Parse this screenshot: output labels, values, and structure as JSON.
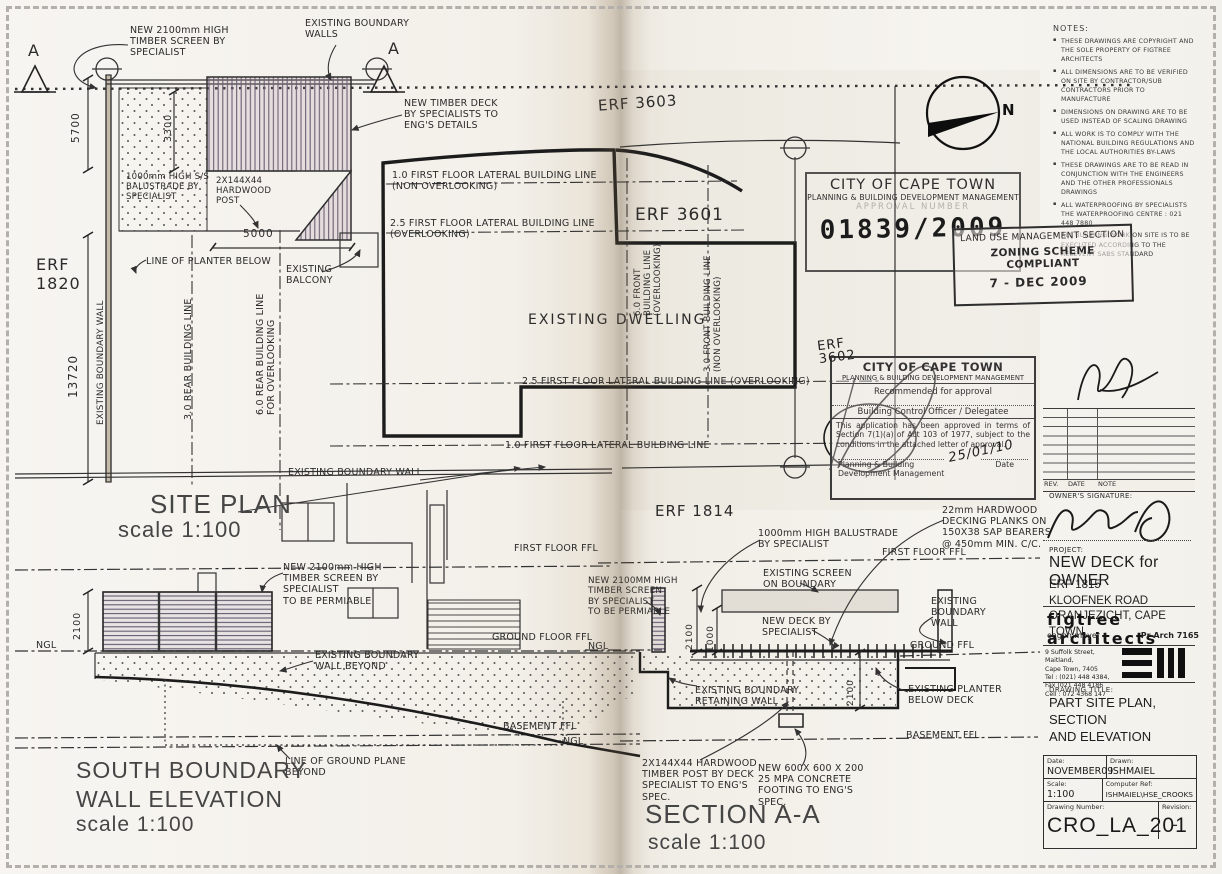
{
  "compass": {
    "n": "N"
  },
  "site_plan": {
    "title": "SITE PLAN",
    "scale": "scale 1:100",
    "marker_a_left": "A",
    "marker_a_right": "A",
    "erf_1820": "ERF\n1820",
    "erf_3603": "ERF 3603",
    "erf_3601": "ERF 3601",
    "erf_1814": "ERF 1814",
    "dims": {
      "d5700": "5700",
      "d3300": "3300",
      "d5000": "5000",
      "d13720": "13720"
    },
    "ann": {
      "new_screen": "NEW 2100mm HIGH\nTIMBER SCREEN BY\nSPECIALIST",
      "existing_boundary_walls": "EXISTING BOUNDARY\nWALLS",
      "new_timber_deck": "NEW TIMBER DECK\nBY SPECIALISTS TO\nENG'S DETAILS",
      "balustrade": "1000mm HIGH S/S\nBALUSTRADE BY\nSPECIALIST",
      "hardwood_post": "2X144X44\nHARDWOOD\nPOST",
      "line_planter": "LINE OF PLANTER BELOW",
      "existing_balcony": "EXISTING\nBALCONY",
      "boundary_wall_left": "EXISTING BOUNDARY WALL",
      "rear_3_0": "3.0 REAR BUILDING LINE",
      "rear_6_0": "6.0 REAR BUILDING LINE\nFOR OVERLOOKING",
      "lateral_1_0_top": "1.0 FIRST FLOOR LATERAL BUILDING LINE\n(NON OVERLOOKING)",
      "lateral_2_5_top": "2.5 FIRST FLOOR LATERAL BUILDING LINE\n(OVERLOOKING)",
      "existing_dwelling": "EXISTING DWELLING",
      "front_6_0": "6.0 FRONT\nBUILDING LINE\n(OVERLOOKING)",
      "front_3_0": "3.0 FRONT BUILDING LINE\n(NON OVERLOOKING)",
      "lateral_2_5_bottom": "2.5 FIRST FLOOR LATERAL BUILDING LINE (OVERLOOKING)",
      "lateral_1_0_bottom": "1.0 FIRST FLOOR LATERAL BUILDING LINE",
      "boundary_wall_bottom": "EXISTING BOUNDARY WALL"
    }
  },
  "elevation": {
    "title": "SOUTH BOUNDARY\nWALL ELEVATION",
    "scale": "scale 1:100",
    "ann": {
      "first_floor_ffl": "FIRST FLOOR FFL",
      "new_screen": "NEW 2100mm HIGH\nTIMBER SCREEN BY\nSPECIALIST\nTO BE PERMIABLE",
      "dim_2100": "2100",
      "ngl_left": "NGL",
      "ground_floor_ffl": "GROUND FLOOR FFL",
      "boundary_beyond": "EXISTING BOUNDARY\nWALL BEYOND",
      "basement_ffl": "BASEMENT FFL",
      "ngl_right": "NGL",
      "ground_plane": "LINE OF GROUND PLANE\nBEYOND"
    }
  },
  "section": {
    "title": "SECTION A-A",
    "scale": "scale 1:100",
    "ann": {
      "balustrade": "1000mm HIGH BALUSTRADE\nBY SPECIALIST",
      "decking": "22mm HARDWOOD\nDECKING PLANKS ON\n150X38 SAP BEARERS\n@ 450mm MIN. C/C.",
      "first_floor_ffl": "FIRST FLOOR FFL",
      "new_screen": "NEW 2100MM HIGH\nTIMBER SCREEN\nBY SPECIALIST\nTO BE PERMIABLE",
      "existing_screen": "EXISTING SCREEN\nON BOUNDARY",
      "new_deck": "NEW DECK BY\nSPECIALIST",
      "boundary_wall": "EXISTING\nBOUNDARY\nWALL",
      "ngl": "NGL",
      "ground_ffl": "GROUND FFL",
      "dim_2100": "2100",
      "dim_1000": "1000",
      "dim_2100_b": "2100",
      "retaining_wall": "EXISTING BOUNDARY\nRETAINING WALL",
      "planter": "EXISTING PLANTER\nBELOW DECK",
      "basement_ffl": "BASEMENT FFL",
      "timber_post": "2X144X44 HARDWOOD\nTIMBER POST BY DECK\nSPECIALIST TO ENG'S\nSPEC.",
      "footing": "NEW 600X 600 X 200\n25 MPA CONCRETE\nFOOTING TO ENG'S\nSPEC."
    }
  },
  "notes": {
    "title": "NOTES:",
    "items": [
      "THESE DRAWINGS ARE COPYRIGHT AND THE SOLE PROPERTY OF FIGTREE ARCHITECTS",
      "ALL DIMENSIONS ARE TO BE VERIFIED ON SITE BY CONTRACTOR/SUB CONTRACTORS PRIOR TO MANUFACTURE",
      "DIMENSIONS ON DRAWING ARE TO BE USED INSTEAD OF SCALING DRAWING",
      "ALL WORK IS TO COMPLY WITH THE NATIONAL BUILDING REGULATIONS AND THE LOCAL AUTHORITIES BY-LAWS",
      "THESE DRAWINGS ARE TO BE READ IN CONJUNCTION WITH THE ENGINEERS AND THE OTHER PROFESSIONALS DRAWINGS",
      "ALL WATERPROOFING BY SPECIALISTS THE WATERPROOFING CENTRE : 021 448 7880",
      "ALL BUILDING WORK ON SITE IS TO BE EXECUTED ACCORDING TO THE RELEVENT SABS STANDARD"
    ]
  },
  "stamps": {
    "approval_number": {
      "org": "CITY OF CAPE TOWN",
      "dept": "PLANNING & BUILDING DEVELOPMENT MANAGEMENT",
      "label": "APPROVAL NUMBER",
      "number": "01839/2009"
    },
    "zoning": {
      "section": "LAND USE MANAGEMENT SECTION",
      "status": "ZONING SCHEME COMPLIANT",
      "date": "7 - DEC 2009"
    },
    "approval": {
      "org": "CITY OF CAPE TOWN",
      "dept": "PLANNING & BUILDING DEVELOPMENT MANAGEMENT",
      "recommended": "Recommended for approval",
      "officer": "Building Control Officer / Delegatee",
      "body": "This application has been approved in terms of Section 7(1)(a) of Act 103 of 1977, subject to the conditions in the attached letter of approval.",
      "sign_dept": "Planning & Building\nDevelopment Management",
      "date_label": "Date",
      "date_value": "25/01/10"
    },
    "erf_3602": "ERF\n3602"
  },
  "title_block": {
    "rev_header": {
      "rev": "REV.",
      "date": "DATE",
      "note": "NOTE"
    },
    "owners_signature": "OWNER'S SIGNATURE:",
    "project_label": "PROJECT:",
    "project_name": "NEW DECK for OWNER",
    "site_address": "ERF 1815\nKLOOFNEK ROAD\nORANJEZICHT, CAPE TOWN",
    "firm_name": "figtree architects",
    "firm_principal": "eagon meyer",
    "firm_reg": "Pr Arch 7165",
    "firm_contact": "9 Suffolk Street, Maitland,\nCape Town, 7405\nTel : (021) 448 4384,\nFax (021 448 4186\nCell : 072 4368 147",
    "drawing_title_label": "DRAWING TITLE:",
    "drawing_title": "PART SITE PLAN, SECTION\nAND ELEVATION",
    "date_label": "Date:",
    "date_value": "NOVEMBER09",
    "drawn_label": "Drawn:",
    "drawn_value": "ISHMAIEL",
    "scale_label": "Scale:",
    "scale_value": "1:100",
    "ref_label": "Computer Ref:",
    "ref_value": "ISHMAIEL\\HSE_CROOKS",
    "number_label": "Drawing Number:",
    "number_value": "CRO_LA_201",
    "revision_label": "Revision:",
    "revision_value": "-"
  }
}
